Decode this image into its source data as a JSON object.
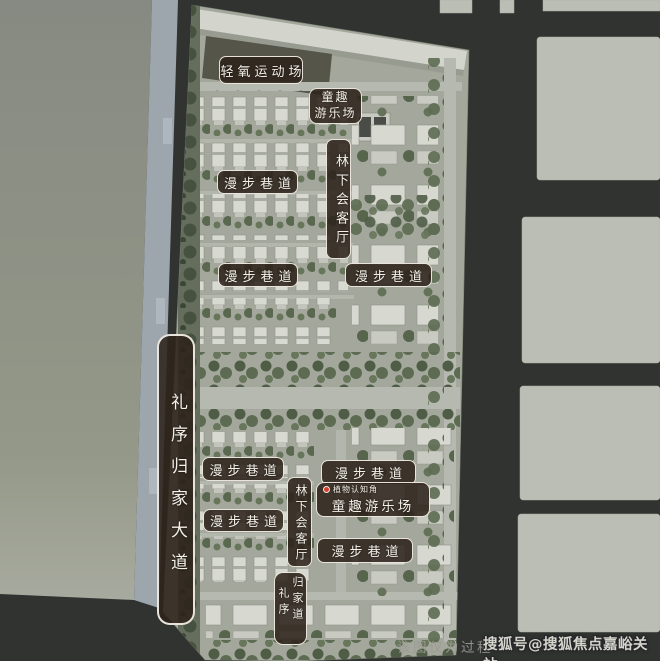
{
  "map": {
    "labels": {
      "sports_field": "轻氧运动场",
      "kids_zone_top": {
        "line1": "童趣",
        "line2": "游乐场"
      },
      "stroll_lane": "漫步巷道",
      "forest_lounge": "林下会客厅",
      "ritual_avenue": "礼序归家大道",
      "plant_corner": "植物认知角",
      "kids_zone_bottom": "童趣游乐场",
      "homecoming_col_right": "归家道",
      "homecoming_col_left": "礼序"
    }
  },
  "watermark": {
    "disclaimer": "该图仅为过程",
    "sohu": "搜狐号@搜狐焦点嘉峪关站"
  },
  "colors": {
    "label_bg": "#2e231b",
    "label_border": "#f8f4ec",
    "label_text": "#f4f0e8",
    "road_dark": "#30332f",
    "parcel_left": "#8a8e86",
    "parcel_right": "#babeb4",
    "road_left_blue": "#9da5ad",
    "site_base": "#a4a89c",
    "tree_green": "#5a6850",
    "building_white": "#d8d9d1",
    "plant_dot_red": "#d43c2f"
  }
}
